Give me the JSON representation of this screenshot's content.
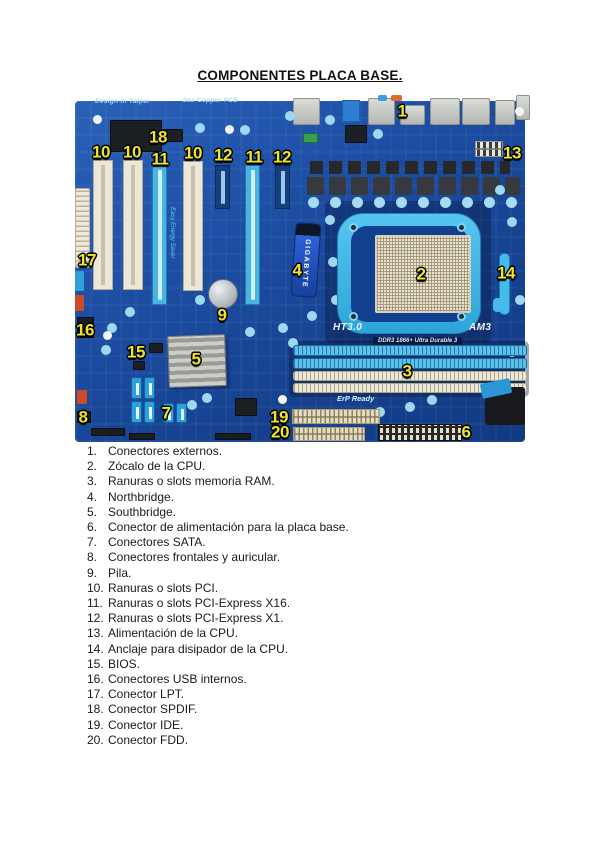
{
  "title": "COMPONENTES PLACA BASE.",
  "figure": {
    "description": "Placa base Gigabyte AM3 con numeración de componentes",
    "board_texts": {
      "brand_vertical": "GIGABYTE",
      "ht": "HT3.0",
      "socket": "AM3",
      "ddr": "DDR3 1866+ Ultra Durable 3",
      "erp": "ErP Ready",
      "copper": "2oz Copper PCB",
      "design": "Design In Taipei",
      "ees": "Easy Energy Saver"
    },
    "colors": {
      "pcb_blue": "#1d4fa5",
      "accent_cyan": "#45bbe9",
      "slot_cream": "#ece7d6",
      "callout_yellow": "#efe32c"
    },
    "callouts": [
      {
        "n": "1"
      },
      {
        "n": "18"
      },
      {
        "n": "10"
      },
      {
        "n": "10"
      },
      {
        "n": "11"
      },
      {
        "n": "10"
      },
      {
        "n": "12"
      },
      {
        "n": "11"
      },
      {
        "n": "12"
      },
      {
        "n": "13"
      },
      {
        "n": "17"
      },
      {
        "n": "4"
      },
      {
        "n": "2"
      },
      {
        "n": "14"
      },
      {
        "n": "9"
      },
      {
        "n": "16"
      },
      {
        "n": "15"
      },
      {
        "n": "5"
      },
      {
        "n": "3"
      },
      {
        "n": "7"
      },
      {
        "n": "8"
      },
      {
        "n": "19"
      },
      {
        "n": "20"
      },
      {
        "n": "6"
      }
    ]
  },
  "list": {
    "items": [
      {
        "num": "1.",
        "text": "Conectores externos."
      },
      {
        "num": "2.",
        "text": "Zócalo de la CPU."
      },
      {
        "num": "3.",
        "text": "Ranuras o slots memoria RAM."
      },
      {
        "num": "4.",
        "text": "Northbridge."
      },
      {
        "num": "5.",
        "text": "Southbridge."
      },
      {
        "num": "6.",
        "text": "Conector de alimentación para la placa base."
      },
      {
        "num": "7.",
        "text": "Conectores SATA."
      },
      {
        "num": "8.",
        "text": "Conectores frontales y auricular."
      },
      {
        "num": "9.",
        "text": "Pila."
      },
      {
        "num": "10.",
        "text": "Ranuras o slots PCI."
      },
      {
        "num": "11.",
        "text": "Ranuras o slots PCI-Express X16."
      },
      {
        "num": "12.",
        "text": "Ranuras o slots PCI-Express X1."
      },
      {
        "num": "13.",
        "text": "Alimentación de la CPU."
      },
      {
        "num": "14.",
        "text": "Anclaje para disipador de la CPU."
      },
      {
        "num": "15.",
        "text": "BIOS."
      },
      {
        "num": "16.",
        "text": "Conectores USB internos."
      },
      {
        "num": "17.",
        "text": "Conector LPT."
      },
      {
        "num": "18.",
        "text": "Conector SPDIF."
      },
      {
        "num": "19.",
        "text": "Conector IDE."
      },
      {
        "num": "20.",
        "text": "Conector FDD."
      }
    ]
  }
}
